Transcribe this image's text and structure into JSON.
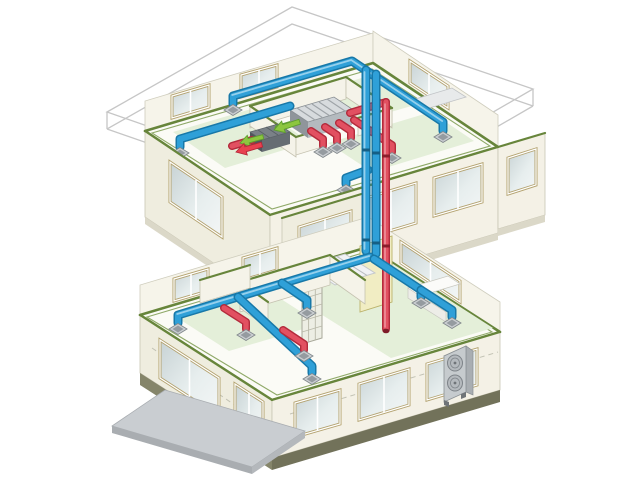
{
  "illustration": {
    "alt_text": "Isometric cutaway of a two-story house showing a central ducted air-conditioning and ventilation system",
    "roof": {
      "style": "wireframe outline, lifted above second floor"
    },
    "second_floor": {
      "units": [
        "indoor-air-handling-unit",
        "heat-exchange-ventilator"
      ],
      "supply_diffusers": 4,
      "return_grilles": 4,
      "airflow_arrows": {
        "fresh_air_green": 2,
        "exhaust_red": 1
      }
    },
    "risers": {
      "supply_blue": 2,
      "return_red": 1,
      "shaft": "between floors"
    },
    "first_floor": {
      "supply_diffusers": 5,
      "return_grilles": 2,
      "features": [
        "staircase",
        "lattice-screen",
        "kitchen-counter",
        "entrance-door",
        "entrance-porch"
      ]
    },
    "outdoor_unit": {
      "fans": 2,
      "location": "right side of first floor"
    }
  },
  "colors": {
    "background": "#FFFFFF",
    "supply": "#2FA0D8",
    "supply_dark": "#1878A8",
    "supply_hi": "#A8D8F0",
    "return": "#E25061",
    "return_dark": "#B32B3C",
    "return_hi": "#F2A3AC",
    "fresh": "#8CC63F",
    "fresh_dark": "#5E9E2E",
    "wall": "#EFEDDF",
    "wall_light": "#F6F4EA",
    "plate": "#67853B",
    "floor_tint": "#E4EFD9",
    "roof_line": "#C6C6C6",
    "unit_gray": "#D7DBDE",
    "unit_dark": "#7A8187",
    "diffuser": "#CBCFD2",
    "window_frame": "#B3A26F",
    "porch": "#C9CDD1",
    "foundation": "#85856A",
    "shaft": "#F1EDC3"
  }
}
